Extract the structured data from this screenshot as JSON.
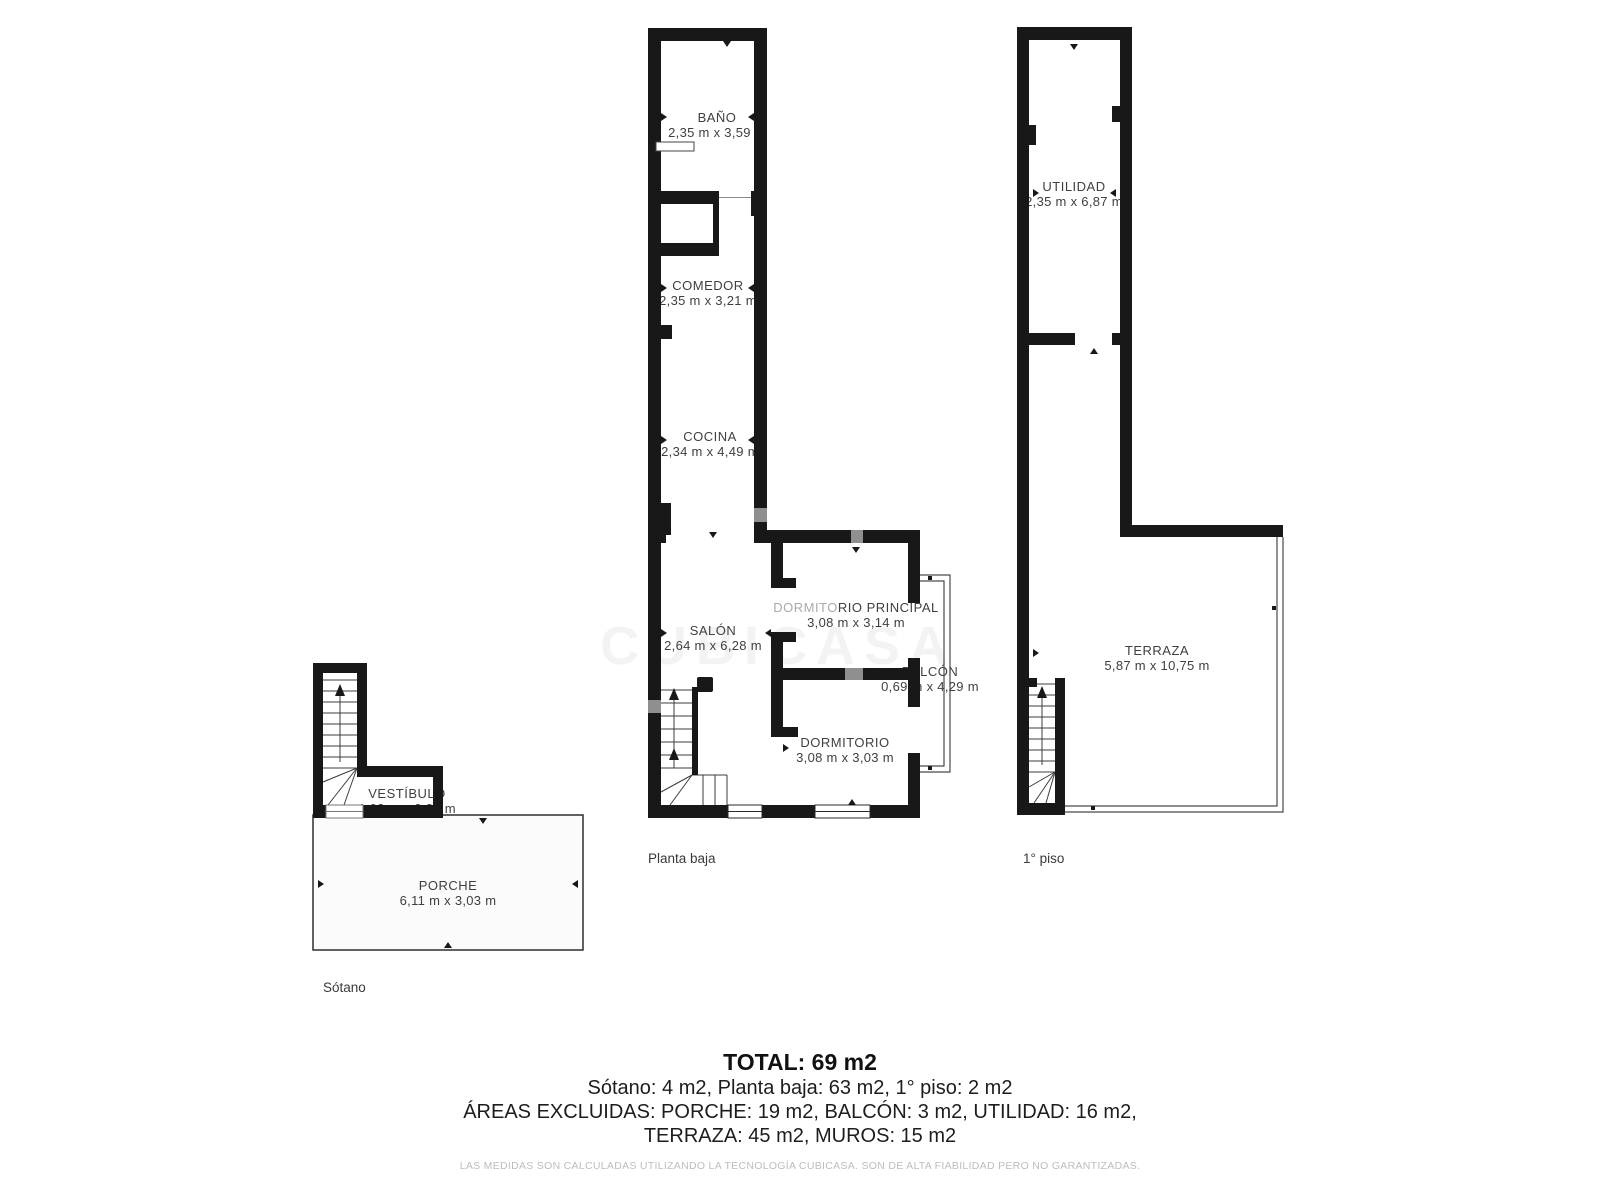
{
  "rooms": {
    "bano": {
      "name": "BAÑO",
      "dims": "2,35 m x 3,59 m"
    },
    "comedor": {
      "name": "COMEDOR",
      "dims": "2,35 m x 3,21 m"
    },
    "cocina": {
      "name": "COCINA",
      "dims": "2,34 m x 4,49 m"
    },
    "salon": {
      "name": "SALÓN",
      "dims": "2,64 m x 6,28 m"
    },
    "dormitorio_principal": {
      "name_part1": "DORMITO",
      "name_part2": "RIO PRINCIPAL",
      "dims": "3,08 m x 3,14 m"
    },
    "dormitorio": {
      "name": "DORMITORIO",
      "dims": "3,08 m x 3,03 m"
    },
    "balcon": {
      "name": "BALCÓN",
      "dims": "0,69 m x 4,29 m"
    },
    "utilidad": {
      "name": "UTILIDAD",
      "dims": "2,35 m x 6,87 m"
    },
    "terraza": {
      "name": "TERRAZA",
      "dims": "5,87 m x 10,75 m"
    },
    "vestibulo": {
      "name": "VESTÍBULO",
      "dims": "1,03 m x 0,81 m"
    },
    "porche": {
      "name": "PORCHE",
      "dims": "6,11 m x 3,03 m"
    }
  },
  "floor_labels": {
    "planta_baja": "Planta baja",
    "primer_piso": "1° piso",
    "sotano": "Sótano"
  },
  "summary": {
    "total": "TOTAL: 69 m2",
    "line2": "Sótano: 4 m2, Planta baja: 63 m2, 1° piso: 2 m2",
    "line3": "ÁREAS EXCLUIDAS: PORCHE: 19 m2, BALCÓN: 3 m2, UTILIDAD: 16 m2,",
    "line4": "TERRAZA: 45 m2, MUROS: 15 m2"
  },
  "disclaimer": "LAS MEDIDAS SON CALCULADAS UTILIZANDO LA TECNOLOGÍA CUBICASA. SON DE ALTA FIABILIDAD PERO NO GARANTIZADAS.",
  "watermark": "CUBICASA",
  "colors": {
    "wall": "#181818",
    "gray_wall": "#8f8f8f",
    "text": "#3f3f3f",
    "porche_fill": "#fbfbfb",
    "disclaimer": "#bdbdbd"
  }
}
